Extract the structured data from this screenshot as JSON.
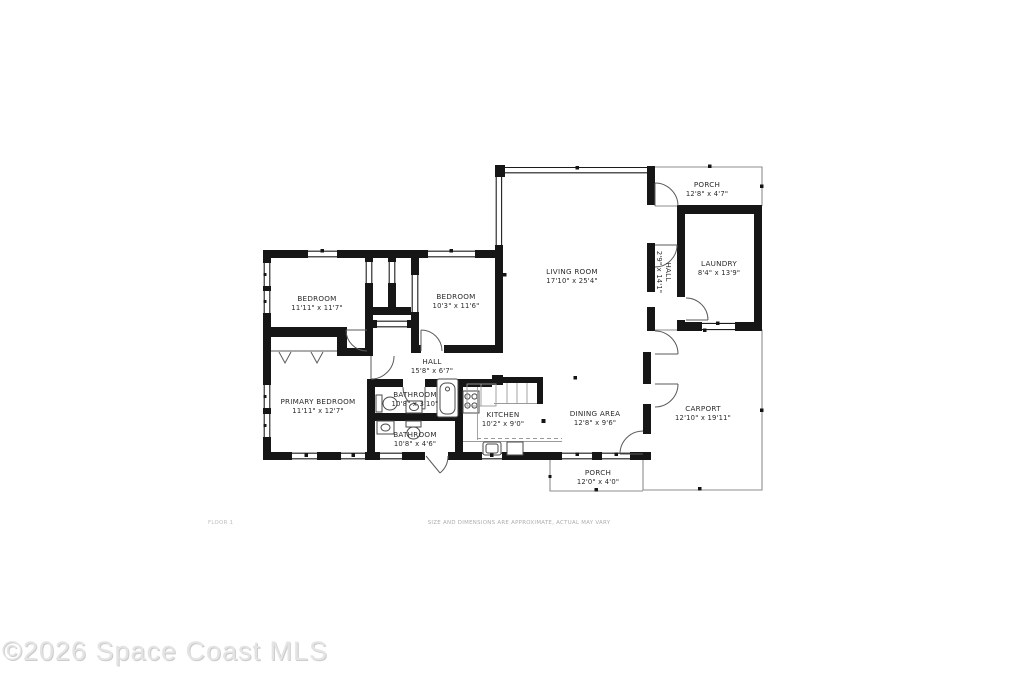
{
  "floorplan": {
    "rooms": [
      {
        "name": "PORCH",
        "dims": "12'8\" x 4'7\""
      },
      {
        "name": "LAUNDRY",
        "dims": "8'4\" x 13'9\""
      },
      {
        "name": "HALL",
        "dims": "2'9\" x 14'1\""
      },
      {
        "name": "LIVING ROOM",
        "dims": "17'10\" x 25'4\""
      },
      {
        "name": "BEDROOM",
        "dims": "11'11\" x 11'7\""
      },
      {
        "name": "BEDROOM",
        "dims": "10'3\" x 11'6\""
      },
      {
        "name": "HALL",
        "dims": "15'8\" x 6'7\""
      },
      {
        "name": "PRIMARY BEDROOM",
        "dims": "11'11\" x 12'7\""
      },
      {
        "name": "BATHROOM",
        "dims": "10'8\" x 3'10\""
      },
      {
        "name": "BATHROOM",
        "dims": "10'8\" x 4'6\""
      },
      {
        "name": "KITCHEN",
        "dims": "10'2\" x 9'0\""
      },
      {
        "name": "DINING AREA",
        "dims": "12'8\" x 9'6\""
      },
      {
        "name": "CARPORT",
        "dims": "12'10\" x 19'11\""
      },
      {
        "name": "PORCH",
        "dims": "12'0\" x 4'0\""
      }
    ],
    "footer": {
      "floor_label": "FLOOR 1",
      "disclaimer": "SIZE AND DIMENSIONS ARE APPROXIMATE, ACTUAL MAY VARY",
      "watermark": "©2026 Space Coast MLS"
    }
  }
}
